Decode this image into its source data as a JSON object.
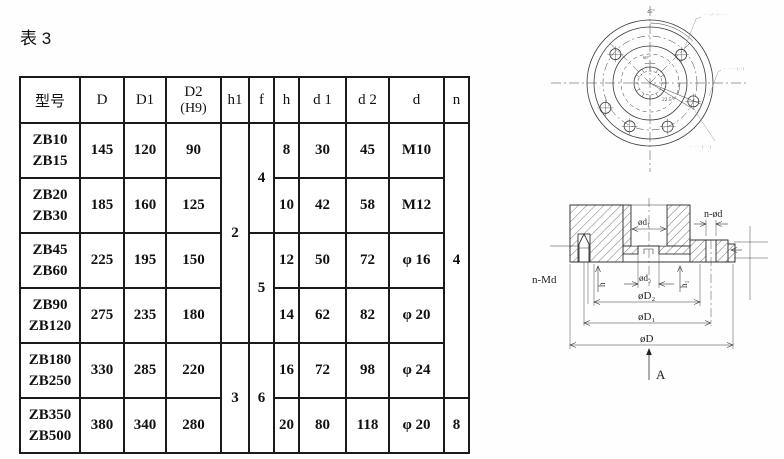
{
  "page": {
    "title": "表 3"
  },
  "table": {
    "headers": {
      "model": "型号",
      "D": "D",
      "D1": "D1",
      "D2_line1": "D2",
      "D2_line2": "(H9)",
      "h1": "h1",
      "f": "f",
      "h": "h",
      "d1": "d 1",
      "d2": "d 2",
      "d": "d",
      "n": "n"
    },
    "rows": [
      {
        "m1": "ZB10",
        "m2": "ZB15",
        "D": "145",
        "D1": "120",
        "D2": "90",
        "h": "8",
        "d1": "30",
        "d2": "45",
        "d": "M10"
      },
      {
        "m1": "ZB20",
        "m2": "ZB30",
        "D": "185",
        "D1": "160",
        "D2": "125",
        "h": "10",
        "d1": "42",
        "d2": "58",
        "d": "M12"
      },
      {
        "m1": "ZB45",
        "m2": "ZB60",
        "D": "225",
        "D1": "195",
        "D2": "150",
        "h": "12",
        "d1": "50",
        "d2": "72",
        "d": "φ 16"
      },
      {
        "m1": "ZB90",
        "m2": "ZB120",
        "D": "275",
        "D1": "235",
        "D2": "180",
        "h": "14",
        "d1": "62",
        "d2": "82",
        "d": "φ 20"
      },
      {
        "m1": "ZB180",
        "m2": "ZB250",
        "D": "330",
        "D1": "285",
        "D2": "220",
        "h": "16",
        "d1": "72",
        "d2": "98",
        "d": "φ 24"
      },
      {
        "m1": "ZB350",
        "m2": "ZB500",
        "D": "380",
        "D1": "340",
        "D2": "280",
        "h": "20",
        "d1": "80",
        "d2": "118",
        "d": "φ 20"
      }
    ],
    "merged": {
      "h1_top": "2",
      "h1_bottom": "3",
      "f_top": "4",
      "f_mid": "5",
      "f_bottom": "6",
      "n_top": "4",
      "n_bottom": "8"
    }
  },
  "face_view": {
    "angle_top": "45°",
    "angle_center": "60°",
    "angle_right": "22.5°",
    "note_top": "·····/··/·····",
    "note_right": "·· ·····(··)",
    "note_bottom": "·· ····(···)"
  },
  "section_view": {
    "label_n_od": "n-ød",
    "label_n_md": "n-Md",
    "label_d1": "ød₁",
    "label_d2": "ød₂",
    "label_h": "h",
    "label_h1": "h₁",
    "label_D2": "øD₂",
    "label_D1": "øD₁",
    "label_D": "øD",
    "label_A": "A"
  }
}
